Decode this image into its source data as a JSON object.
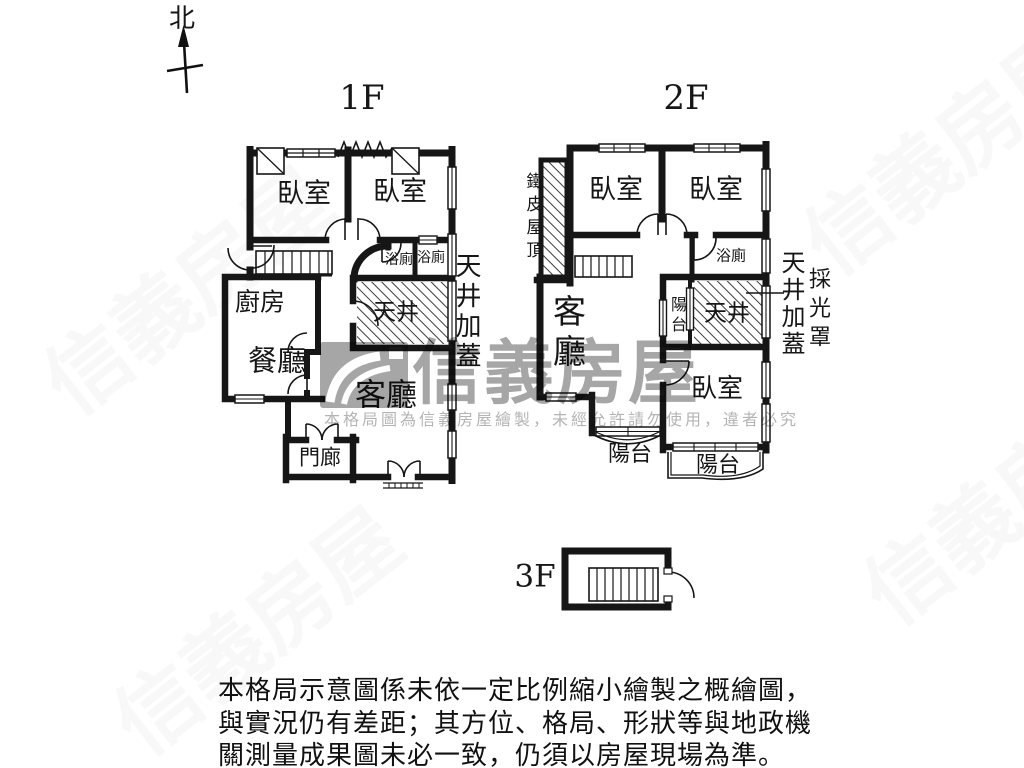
{
  "north_label": "北",
  "floor1": {
    "title": "1F",
    "bedroom1": "臥室",
    "bedroom2": "臥室",
    "bath1": "浴廁",
    "bath2": "浴廁",
    "kitchen": "廚房",
    "dining": "餐廳",
    "lightwell": "天井",
    "living": "客廳",
    "porch": "門廊",
    "lightwell_cover": "天井加蓋"
  },
  "floor2": {
    "title": "2F",
    "iron_roof": "鐵皮屋頂",
    "bedroom1": "臥室",
    "bedroom2": "臥室",
    "bath": "浴廁",
    "living": "客廳",
    "balcony_mid": "陽台",
    "lightwell": "天井",
    "bedroom3": "臥室",
    "balcony_left": "陽台",
    "balcony_right": "陽台",
    "lightwell_cover": "天井加蓋",
    "light_cover": "採光罩"
  },
  "floor3": {
    "title": "3F"
  },
  "watermark": {
    "brand": "信義房屋",
    "notice": "本格局圖為信義房屋繪製，未經允許請勿使用，違者必究"
  },
  "footer": {
    "line1": "本格局示意圖係未依一定比例縮小繪製之概繪圖，",
    "line2": "與實況仍有差距；其方位、格局、形狀等與地政機",
    "line3": "關測量成果圖未必一致，仍須以房屋現場為準。"
  },
  "colors": {
    "wall": "#161616",
    "watermark_gray": "#a6a6a6"
  }
}
